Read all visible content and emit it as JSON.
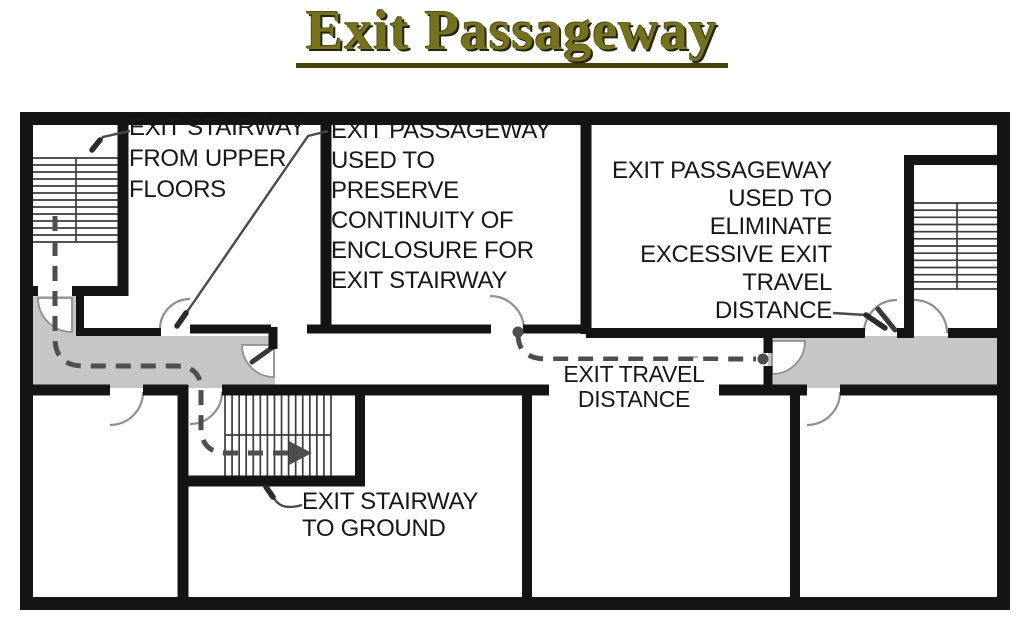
{
  "title": "Exit Passageway",
  "labels": {
    "upper_stair": "EXIT STAIRWAY\nFROM UPPER\nFLOORS",
    "continuity": "EXIT PASSAGEWAY\nUSED TO\nPRESERVE\nCONTINUITY OF\nENCLOSURE FOR\nEXIT STAIRWAY",
    "eliminate": "EXIT PASSAGEWAY\nUSED TO\nELIMINATE\nEXCESSIVE EXIT\nTRAVEL\nDISTANCE",
    "travel_distance": "EXIT TRAVEL\nDISTANCE",
    "ground_stair": "EXIT STAIRWAY\nTO GROUND"
  },
  "colors": {
    "background": "#ffffff",
    "wall": "#141414",
    "corridor": "#c6c6c6",
    "path": "#4e4e4e",
    "door": "#909090",
    "leader": "#4a4a4a",
    "text": "#171717",
    "title": "#76711d",
    "titleline": "#45420f"
  },
  "icons": {
    "route_arrowhead": "solid right-pointing triangle (exit direction into ground stairway)",
    "route_dot": "round endpoint dot of exit-travel-distance line"
  }
}
